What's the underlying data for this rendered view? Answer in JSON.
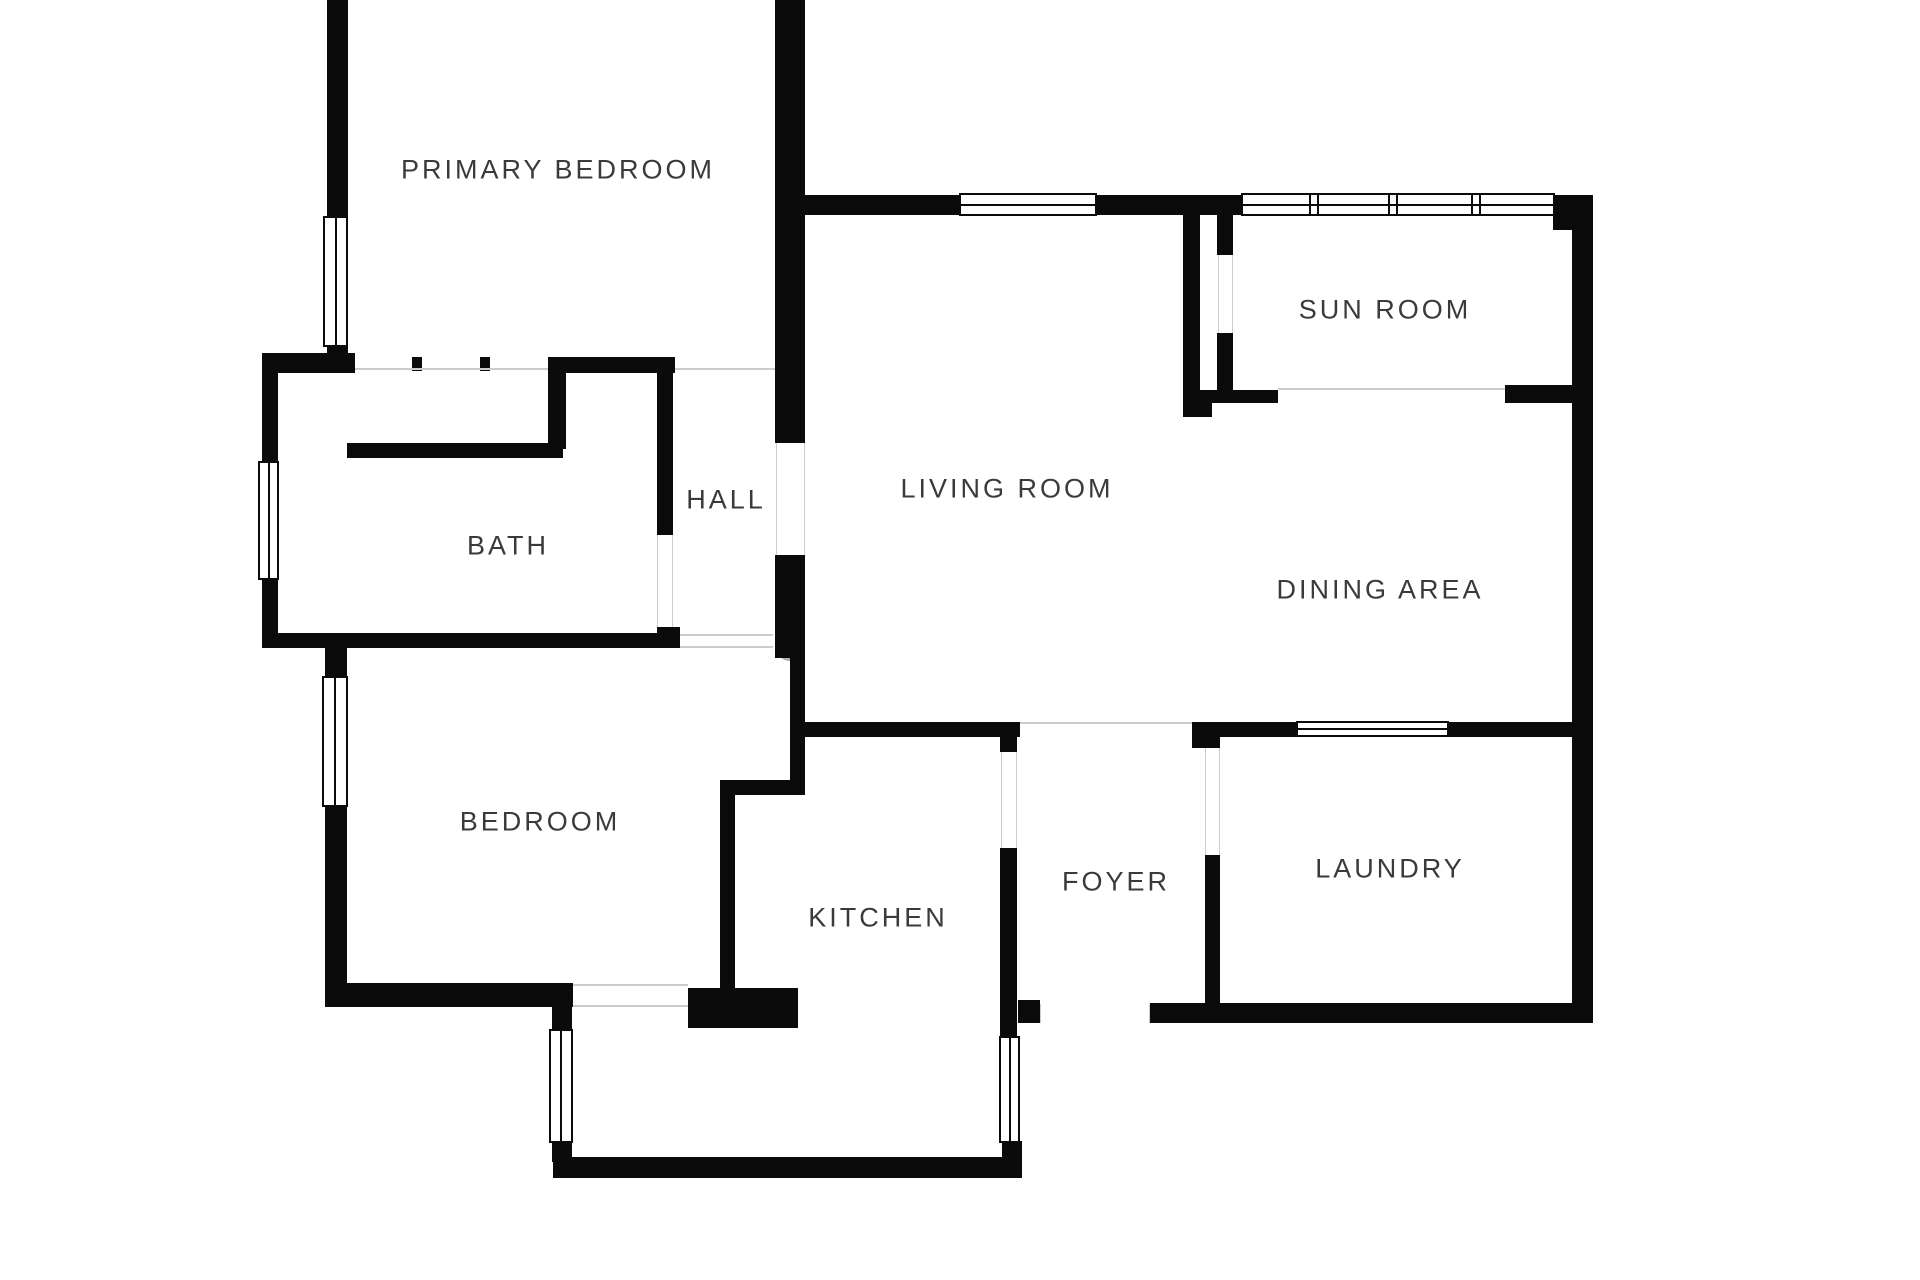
{
  "colors": {
    "wall": "#0b0b0b",
    "label_text": "#3a3a3a",
    "opening_line": "#cccccc",
    "watermark": "#ababab",
    "background": "#ffffff"
  },
  "floorplan": {
    "rooms": [
      {
        "id": "primary-bedroom",
        "label": "PRIMARY BEDROOM",
        "x": 558,
        "y": 170
      },
      {
        "id": "sun-room",
        "label": "SUN ROOM",
        "x": 1385,
        "y": 310
      },
      {
        "id": "living-room",
        "label": "LIVING ROOM",
        "x": 1007,
        "y": 489
      },
      {
        "id": "hall",
        "label": "HALL",
        "x": 726,
        "y": 500
      },
      {
        "id": "bath",
        "label": "BATH",
        "x": 508,
        "y": 546
      },
      {
        "id": "dining-area",
        "label": "DINING AREA",
        "x": 1380,
        "y": 590
      },
      {
        "id": "bedroom",
        "label": "BEDROOM",
        "x": 540,
        "y": 822
      },
      {
        "id": "kitchen",
        "label": "KITCHEN",
        "x": 878,
        "y": 918
      },
      {
        "id": "foyer",
        "label": "FOYER",
        "x": 1116,
        "y": 882
      },
      {
        "id": "laundry",
        "label": "LAUNDRY",
        "x": 1390,
        "y": 869
      }
    ],
    "watermark": {
      "text": "6",
      "x": 790,
      "y": 640
    },
    "walls": [
      [
        327,
        0,
        21,
        220
      ],
      [
        327,
        345,
        21,
        12
      ],
      [
        262,
        353,
        93,
        20
      ],
      [
        548,
        357,
        127,
        16
      ],
      [
        412,
        357,
        10,
        14
      ],
      [
        480,
        357,
        10,
        14
      ],
      [
        548,
        373,
        18,
        76
      ],
      [
        347,
        443,
        216,
        15
      ],
      [
        262,
        373,
        16,
        90
      ],
      [
        262,
        578,
        16,
        70
      ],
      [
        262,
        633,
        418,
        15
      ],
      [
        657,
        373,
        16,
        162
      ],
      [
        657,
        627,
        23,
        21
      ],
      [
        325,
        648,
        22,
        30
      ],
      [
        325,
        805,
        22,
        202
      ],
      [
        325,
        983,
        248,
        24
      ],
      [
        688,
        988,
        110,
        40
      ],
      [
        552,
        1007,
        20,
        24
      ],
      [
        552,
        1141,
        20,
        21
      ],
      [
        553,
        1157,
        469,
        21
      ],
      [
        1002,
        1141,
        20,
        22
      ],
      [
        1000,
        848,
        17,
        190
      ],
      [
        1000,
        737,
        17,
        15
      ],
      [
        790,
        722,
        230,
        15
      ],
      [
        1192,
        722,
        28,
        26
      ],
      [
        1205,
        855,
        15,
        150
      ],
      [
        1018,
        1000,
        22,
        23
      ],
      [
        1150,
        1003,
        443,
        20
      ],
      [
        1193,
        722,
        105,
        15
      ],
      [
        1447,
        722,
        125,
        15
      ],
      [
        1572,
        195,
        21,
        828
      ],
      [
        1553,
        195,
        40,
        35
      ],
      [
        805,
        195,
        156,
        20
      ],
      [
        1095,
        195,
        148,
        20
      ],
      [
        775,
        0,
        30,
        443
      ],
      [
        775,
        555,
        30,
        103
      ],
      [
        790,
        658,
        15,
        137
      ],
      [
        720,
        780,
        85,
        15
      ],
      [
        720,
        780,
        15,
        208
      ],
      [
        1183,
        213,
        17,
        202
      ],
      [
        1217,
        213,
        16,
        42
      ],
      [
        1217,
        333,
        16,
        57
      ],
      [
        1183,
        390,
        29,
        27
      ],
      [
        1212,
        390,
        66,
        13
      ],
      [
        1505,
        385,
        67,
        18
      ]
    ],
    "thin_lines": [
      [
        355,
        368,
        193,
        2
      ],
      [
        675,
        368,
        100,
        2
      ],
      [
        657,
        535,
        1,
        92
      ],
      [
        672,
        535,
        1,
        92
      ],
      [
        776,
        443,
        1,
        112
      ],
      [
        804,
        443,
        1,
        112
      ],
      [
        1218,
        255,
        1,
        78
      ],
      [
        1232,
        255,
        1,
        78
      ],
      [
        1020,
        722,
        172,
        2
      ],
      [
        1278,
        388,
        227,
        2
      ],
      [
        1001,
        752,
        1,
        96
      ],
      [
        1016,
        752,
        1,
        96
      ],
      [
        1205,
        748,
        1,
        107
      ],
      [
        1219,
        748,
        1,
        107
      ],
      [
        1040,
        1004,
        1,
        19
      ],
      [
        1149,
        1004,
        1,
        19
      ],
      [
        573,
        984,
        115,
        2
      ],
      [
        573,
        1005,
        115,
        2
      ],
      [
        680,
        634,
        93,
        2
      ],
      [
        680,
        646,
        93,
        2
      ]
    ],
    "windows": [
      {
        "x": 323,
        "y": 216,
        "w": 25,
        "h": 131,
        "o": "v"
      },
      {
        "x": 258,
        "y": 461,
        "w": 21,
        "h": 119,
        "o": "v"
      },
      {
        "x": 322,
        "y": 676,
        "w": 26,
        "h": 131,
        "o": "v"
      },
      {
        "x": 549,
        "y": 1029,
        "w": 24,
        "h": 114,
        "o": "v"
      },
      {
        "x": 999,
        "y": 1036,
        "w": 21,
        "h": 107,
        "o": "v"
      },
      {
        "x": 959,
        "y": 193,
        "w": 138,
        "h": 23,
        "o": "h"
      },
      {
        "x": 1241,
        "y": 193,
        "w": 314,
        "h": 23,
        "o": "h",
        "mullions": [
          1312,
          1391,
          1474
        ]
      },
      {
        "x": 1296,
        "y": 721,
        "w": 153,
        "h": 16,
        "o": "h"
      }
    ]
  }
}
